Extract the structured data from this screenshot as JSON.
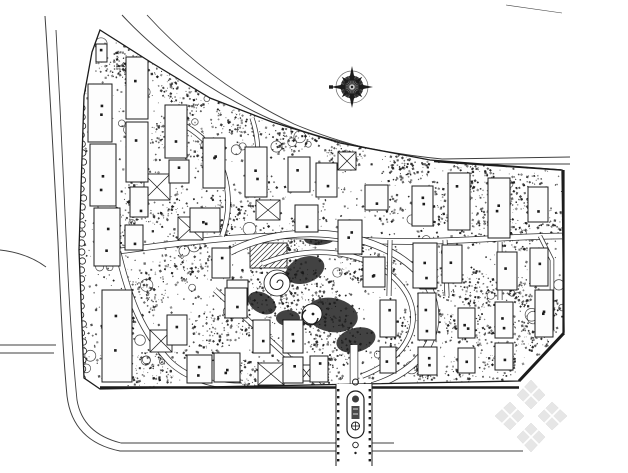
{
  "canvas": {
    "w": 628,
    "h": 473,
    "bg": "#ffffff",
    "ink": "#1c1c1c",
    "road_color": "#3f3f3f",
    "building_fill": "#fdfdfd"
  },
  "site": {
    "boundary": "100,30 152,63 210,98 272,122 340,143 430,160 562,170 564,332 519,381 100,389 84,378 79,250 84,96 92,52",
    "bbox": [
      79,
      30,
      564,
      389
    ],
    "edge_bands": [
      {
        "x1": 100,
        "y1": 387.5,
        "x2": 519,
        "y2": 387.5,
        "w": 2.6
      },
      {
        "x1": 519,
        "y1": 381,
        "x2": 564,
        "y2": 333,
        "w": 3
      },
      {
        "x1": 563.5,
        "y1": 170,
        "x2": 563.5,
        "y2": 333,
        "w": 2.2
      },
      {
        "x1": 434,
        "y1": 161.5,
        "x2": 561,
        "y2": 170,
        "w": 1.6
      }
    ]
  },
  "outer_roads": [
    {
      "d": "M45,16 C50,90 54,170 58,242 C61,312 63,352 67,396 C71,428 90,445 120,451 L523,451",
      "w": 1
    },
    {
      "d": "M56,30 C60,105 64,185 67,255 C70,320 73,360 77,400 C81,424 97,437 121,443 L336,443",
      "w": 0.9
    },
    {
      "d": "M372,443 L394,443",
      "w": 0.9
    },
    {
      "d": "M0,345 L56,345",
      "w": 0.9
    },
    {
      "d": "M0,353 L54,353",
      "w": 0.9
    },
    {
      "d": "M0,250 C18,252 34,258 46,267",
      "w": 0.9
    },
    {
      "d": "M122,15 C160,56 212,93 270,119 C324,141 382,153 442,159 L570,157",
      "w": 1
    },
    {
      "d": "M147,15 C188,60 238,97 294,124 C346,146 402,158 456,164 L570,164",
      "w": 0.9
    },
    {
      "d": "M506,5 L562,13",
      "w": 0.6
    }
  ],
  "inner_roads": [
    {
      "d": "M112,252 C180,243 262,231 332,238 C420,247 502,236 562,236",
      "w": 5
    },
    {
      "d": "M230,252 C298,216 402,234 430,290 C448,334 420,372 372,386",
      "w": 6
    },
    {
      "d": "M262,264 C318,240 386,254 408,296 C424,330 400,362 362,376",
      "w": 4
    },
    {
      "d": "M118,252 C130,302 142,332 170,362 C188,379 214,386 242,386",
      "w": 5
    },
    {
      "d": "M215,290 L322,388",
      "w": 4
    },
    {
      "d": "M170,118 C202,132 220,152 226,182 C230,202 228,220 222,236",
      "w": 4
    },
    {
      "d": "M252,118 C262,148 258,175 248,196",
      "w": 3.5
    },
    {
      "d": "M354,345 L354,387",
      "w": 7
    },
    {
      "d": "M445,240 L447,296",
      "w": 3.5
    },
    {
      "d": "M500,242 L500,300",
      "w": 3.5
    },
    {
      "d": "M390,240 L389,296",
      "w": 3.5
    },
    {
      "d": "M540,236 L552,260 L552,330",
      "w": 3
    }
  ],
  "buildings": [
    [
      96,
      44,
      11,
      18
    ],
    [
      88,
      84,
      24,
      58
    ],
    [
      90,
      144,
      26,
      62
    ],
    [
      94,
      208,
      26,
      58
    ],
    [
      102,
      290,
      30,
      92
    ],
    [
      126,
      57,
      22,
      62
    ],
    [
      126,
      122,
      22,
      60
    ],
    [
      130,
      187,
      18,
      30
    ],
    [
      125,
      225,
      18,
      25
    ],
    [
      165,
      105,
      22,
      53
    ],
    [
      169,
      160,
      20,
      23
    ],
    [
      203,
      138,
      22,
      50
    ],
    [
      245,
      147,
      22,
      50
    ],
    [
      288,
      157,
      22,
      35
    ],
    [
      316,
      163,
      21,
      34
    ],
    [
      190,
      208,
      30,
      24
    ],
    [
      295,
      205,
      23,
      27
    ],
    [
      338,
      220,
      24,
      34
    ],
    [
      365,
      185,
      23,
      25
    ],
    [
      363,
      257,
      22,
      30
    ],
    [
      212,
      248,
      18,
      30
    ],
    [
      227,
      280,
      21,
      25
    ],
    [
      167,
      315,
      20,
      30
    ],
    [
      187,
      355,
      25,
      28
    ],
    [
      214,
      353,
      26,
      29
    ],
    [
      225,
      288,
      22,
      30
    ],
    [
      253,
      320,
      17,
      33
    ],
    [
      283,
      320,
      20,
      33
    ],
    [
      283,
      357,
      20,
      26
    ],
    [
      310,
      356,
      18,
      26
    ],
    [
      412,
      186,
      21,
      40
    ],
    [
      448,
      173,
      22,
      57
    ],
    [
      488,
      178,
      22,
      60
    ],
    [
      528,
      187,
      20,
      35
    ],
    [
      413,
      243,
      24,
      45
    ],
    [
      442,
      245,
      20,
      38
    ],
    [
      497,
      252,
      20,
      38
    ],
    [
      530,
      248,
      18,
      38
    ],
    [
      380,
      300,
      16,
      37
    ],
    [
      418,
      293,
      18,
      47
    ],
    [
      458,
      308,
      17,
      30
    ],
    [
      495,
      302,
      18,
      36
    ],
    [
      535,
      290,
      18,
      47
    ],
    [
      380,
      347,
      16,
      26
    ],
    [
      418,
      347,
      19,
      28
    ],
    [
      458,
      348,
      17,
      25
    ],
    [
      495,
      343,
      18,
      27
    ]
  ],
  "xboxes": [
    [
      144,
      174,
      26,
      26
    ],
    [
      178,
      217,
      25,
      23
    ],
    [
      150,
      330,
      22,
      22
    ],
    [
      258,
      363,
      26,
      22
    ],
    [
      300,
      365,
      13,
      16
    ],
    [
      420,
      273,
      16,
      16
    ],
    [
      256,
      200,
      24,
      20
    ],
    [
      338,
      152,
      18,
      18
    ]
  ],
  "blobs": [
    [
      305,
      270,
      20,
      13,
      -20
    ],
    [
      332,
      315,
      26,
      17,
      10
    ],
    [
      262,
      303,
      15,
      10,
      30
    ],
    [
      356,
      340,
      20,
      12,
      -15
    ],
    [
      320,
      238,
      16,
      7,
      -5
    ],
    [
      288,
      318,
      12,
      8,
      0
    ]
  ],
  "trellis": {
    "x": 250,
    "y": 243,
    "w": 37,
    "h": 25
  },
  "spiral": {
    "cx": 277,
    "cy": 283,
    "r": 13
  },
  "pond": {
    "cx": 312,
    "cy": 314,
    "r": 10
  },
  "veg": {
    "seed": 11,
    "base_count": 2200,
    "dot_min": 0.6,
    "dot_max": 2.4,
    "tree_count": 60,
    "zones": [
      [
        112,
        62,
        16,
        60
      ],
      [
        140,
        62,
        24,
        110
      ],
      [
        186,
        92,
        26,
        120
      ],
      [
        240,
        112,
        24,
        110
      ],
      [
        294,
        130,
        22,
        100
      ],
      [
        346,
        150,
        20,
        90
      ],
      [
        408,
        162,
        22,
        85
      ],
      [
        470,
        180,
        24,
        100
      ],
      [
        525,
        192,
        22,
        90
      ],
      [
        554,
        225,
        16,
        55
      ],
      [
        385,
        205,
        18,
        65
      ],
      [
        438,
        205,
        20,
        75
      ],
      [
        478,
        225,
        22,
        85
      ],
      [
        515,
        235,
        18,
        65
      ],
      [
        385,
        260,
        16,
        55
      ],
      [
        438,
        285,
        18,
        65
      ],
      [
        478,
        290,
        20,
        75
      ],
      [
        520,
        290,
        18,
        65
      ],
      [
        548,
        310,
        14,
        45
      ],
      [
        395,
        330,
        16,
        50
      ],
      [
        440,
        325,
        18,
        60
      ],
      [
        478,
        330,
        16,
        50
      ],
      [
        515,
        330,
        16,
        50
      ],
      [
        420,
        370,
        18,
        55
      ],
      [
        460,
        372,
        16,
        50
      ],
      [
        500,
        362,
        18,
        55
      ],
      [
        540,
        340,
        14,
        40
      ],
      [
        150,
        195,
        28,
        110
      ],
      [
        120,
        235,
        22,
        80
      ],
      [
        185,
        255,
        26,
        100
      ],
      [
        148,
        290,
        22,
        80
      ],
      [
        120,
        320,
        18,
        60
      ],
      [
        215,
        330,
        22,
        80
      ],
      [
        250,
        310,
        26,
        100
      ],
      [
        270,
        260,
        30,
        130
      ],
      [
        310,
        298,
        30,
        140
      ],
      [
        335,
        342,
        26,
        110
      ],
      [
        358,
        262,
        20,
        80
      ],
      [
        300,
        235,
        20,
        80
      ],
      [
        230,
        215,
        18,
        65
      ],
      [
        150,
        370,
        22,
        75
      ],
      [
        250,
        378,
        20,
        65
      ],
      [
        330,
        372,
        16,
        50
      ],
      [
        200,
        150,
        20,
        75
      ],
      [
        262,
        200,
        16,
        55
      ],
      [
        165,
        135,
        16,
        55
      ]
    ]
  },
  "tree_row_left": {
    "x": 82,
    "y0": 90,
    "y1": 380,
    "step": 9,
    "r": 3.2
  },
  "entrance": {
    "x_left": 336,
    "x_right": 372,
    "y_top": 384,
    "y_bottom": 466,
    "tree_step": 7,
    "island": {
      "x": 347,
      "y": 391,
      "w": 17,
      "h": 47,
      "rx": 8.5
    }
  },
  "compass": {
    "cx": 352,
    "cy": 87,
    "r_ring": 16,
    "r_disc": 11.5,
    "p_long": 21,
    "p_short": 14.5,
    "tick": {
      "x": 329,
      "y": 85.3,
      "w": 4,
      "h": 3.4
    }
  },
  "watermark": {
    "cx": 531,
    "cy": 416,
    "color": "#e6e6e6",
    "edge": "#dadada",
    "cross": "#ffffff"
  }
}
